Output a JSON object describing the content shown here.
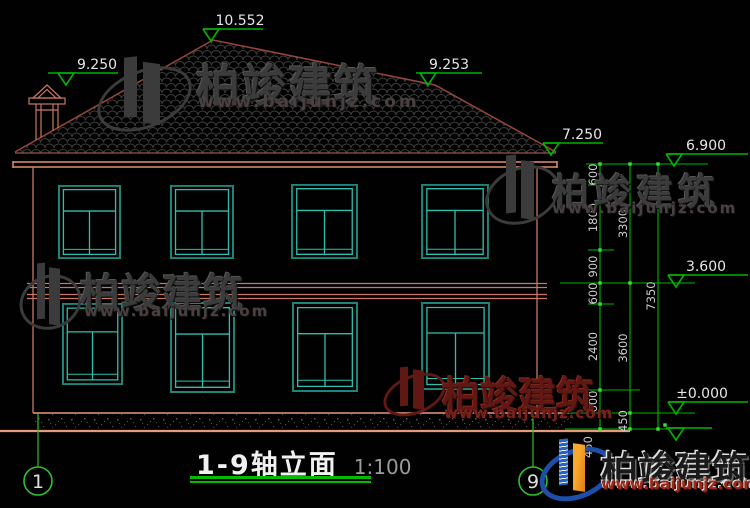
{
  "drawing": {
    "title": "1-9轴立面",
    "scale": "1:100",
    "levels": {
      "ridge": "10.552",
      "chimney": "9.250",
      "roof_right": "9.253",
      "eave_edge": "7.250",
      "eave": "6.900",
      "floor2": "3.600",
      "ground": "±0.000"
    },
    "dims_inner": [
      "600",
      "1800",
      "900",
      "600",
      "2400",
      "600",
      "450"
    ],
    "dims_mid": [
      "3300",
      "3600",
      "450"
    ],
    "dims_total": "7350",
    "axis_left": "1",
    "axis_right": "9"
  },
  "watermark": {
    "brand": "柏竣建筑",
    "url": "www.baijunjz.com"
  },
  "colors": {
    "background": "#010101",
    "wall_line": "#c87763",
    "ground_line": "#e59a7d",
    "roof_line": "#96463a",
    "window_line": "#2fbfae",
    "dimension_green": "#00b400",
    "watermark_gray": "#3b3b3b",
    "watermark_red": "#5f1813",
    "logo_blue": "#1d4ea8",
    "logo_orange": "#f7a82d"
  }
}
